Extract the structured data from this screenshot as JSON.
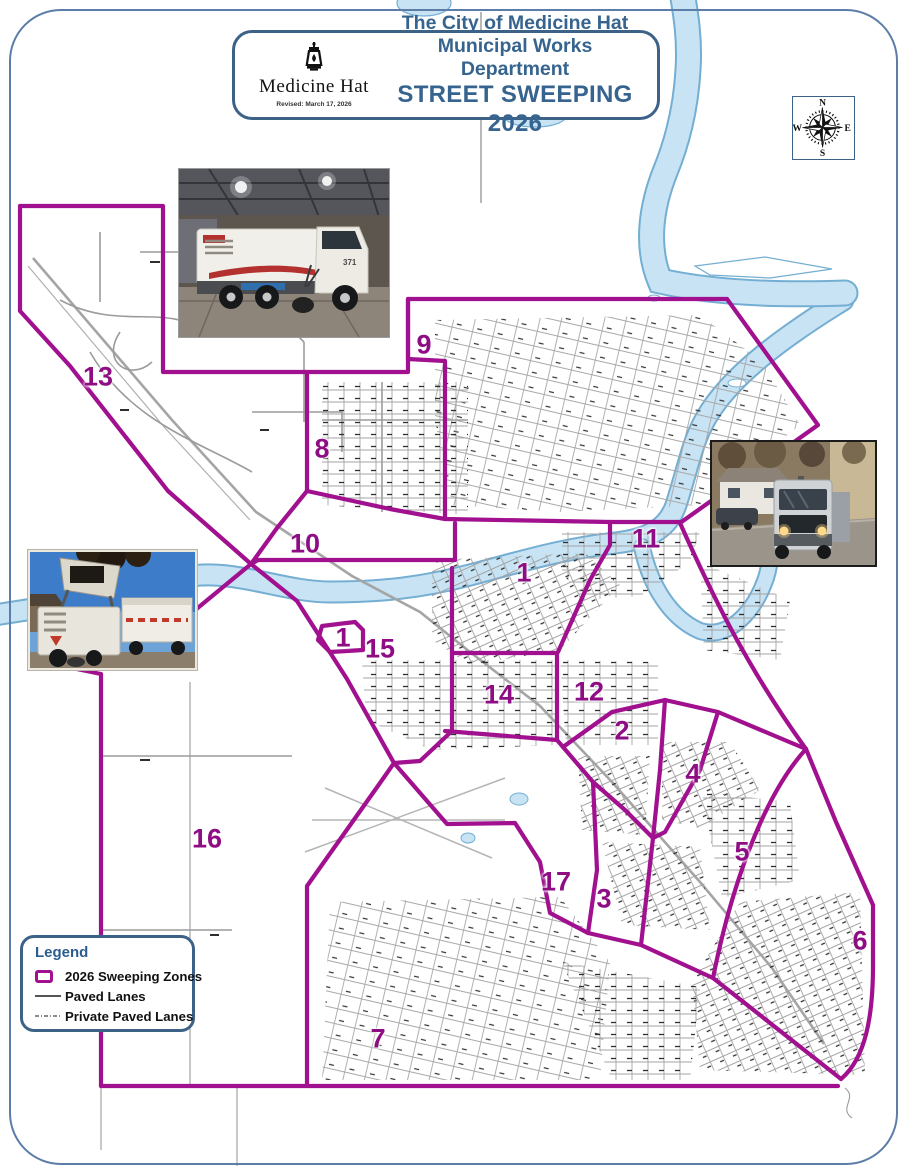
{
  "document": {
    "type": "street sweeping zone map",
    "title_box": {
      "logo_text": "Medicine Hat",
      "revised_note": "Revised: March 17, 2026",
      "line1": "The City of Medicine Hat",
      "line2": "Municipal Works Department",
      "line3": "STREET SWEEPING 2026"
    },
    "compass": {
      "north": "N",
      "east": "E",
      "south": "S",
      "west": "W"
    },
    "legend": {
      "title": "Legend",
      "items": [
        {
          "symbol": "zone-boundary-swatch",
          "label": "2026 Sweeping Zones"
        },
        {
          "symbol": "solid-line-swatch",
          "label": "Paved Lanes"
        },
        {
          "symbol": "dash-line-swatch",
          "label": "Private Paved Lanes"
        }
      ]
    },
    "map": {
      "zone_boundary_color": "#a1108e",
      "zone_label_color": "#8e0d85",
      "river_fill": "#c7e3f4",
      "river_edge": "#74aed2",
      "road_color": "#9b9b9b",
      "zone_labels": [
        {
          "zone": "1",
          "x": 524,
          "y": 573
        },
        {
          "zone": "1",
          "x": 343,
          "y": 638
        },
        {
          "zone": "2",
          "x": 622,
          "y": 731
        },
        {
          "zone": "3",
          "x": 604,
          "y": 899
        },
        {
          "zone": "4",
          "x": 693,
          "y": 774
        },
        {
          "zone": "5",
          "x": 742,
          "y": 852
        },
        {
          "zone": "6",
          "x": 860,
          "y": 941
        },
        {
          "zone": "7",
          "x": 378,
          "y": 1039
        },
        {
          "zone": "8",
          "x": 322,
          "y": 449
        },
        {
          "zone": "9",
          "x": 424,
          "y": 345
        },
        {
          "zone": "10",
          "x": 305,
          "y": 544
        },
        {
          "zone": "11",
          "x": 646,
          "y": 539
        },
        {
          "zone": "12",
          "x": 589,
          "y": 692
        },
        {
          "zone": "13",
          "x": 98,
          "y": 377
        },
        {
          "zone": "14",
          "x": 499,
          "y": 695
        },
        {
          "zone": "15",
          "x": 380,
          "y": 649
        },
        {
          "zone": "16",
          "x": 207,
          "y": 839
        },
        {
          "zone": "17",
          "x": 556,
          "y": 882
        }
      ]
    },
    "photos": [
      {
        "name": "street-sweeper-parked-in-garage",
        "unit_number": "371"
      },
      {
        "name": "street-sweeper-driving-residential-street"
      },
      {
        "name": "street-sweeper-dumping-into-dump-truck"
      }
    ]
  }
}
